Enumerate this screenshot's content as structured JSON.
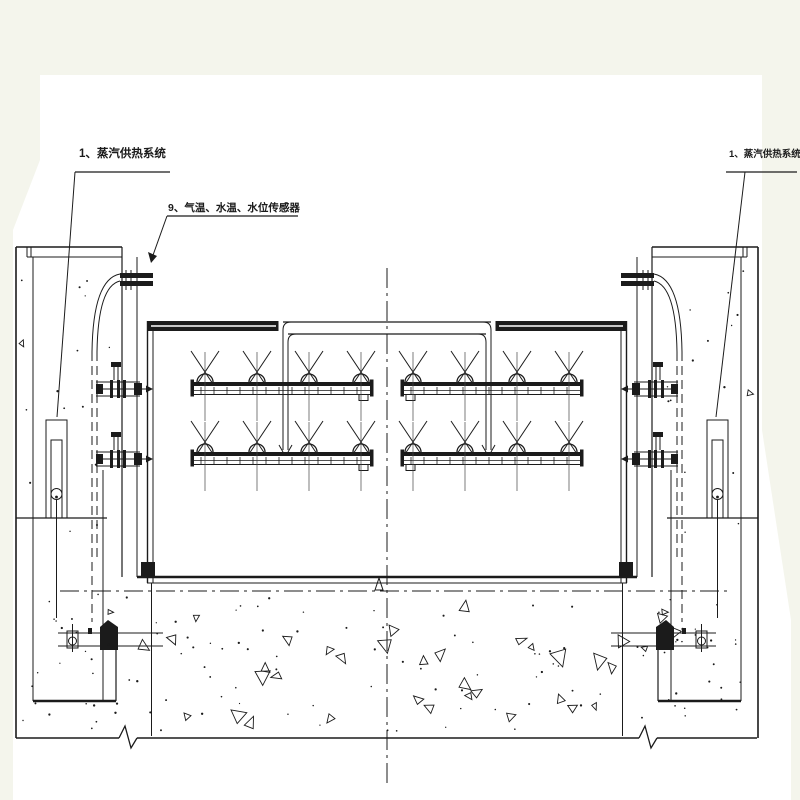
{
  "drawing": {
    "labels": {
      "steam_left": {
        "text": "1、蒸汽供热系统"
      },
      "steam_right": {
        "text": "1、蒸汽供热系统"
      },
      "sensors": {
        "text": "9、气温、水温、水位传感器"
      }
    },
    "colors": {
      "line": "#1b1b1b",
      "paper": "#ffffff",
      "page_bg": "#f4f5ec"
    }
  }
}
